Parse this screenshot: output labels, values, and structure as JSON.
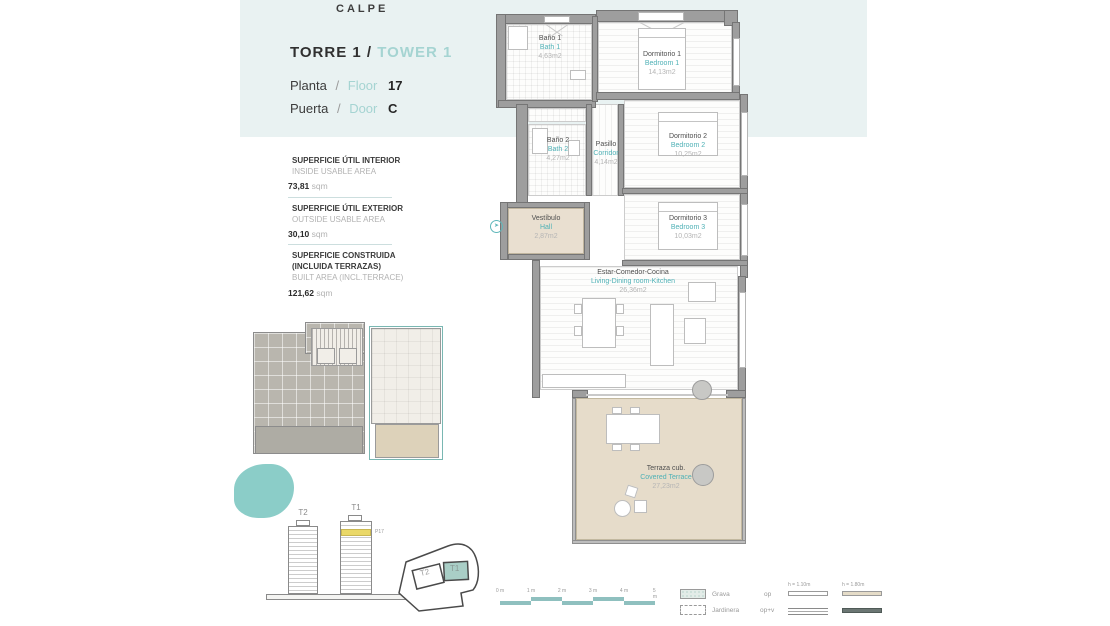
{
  "colors": {
    "header_band": "#e9f2f2",
    "accent_teal": "#4fb1b6",
    "accent_teal_light": "#a5d4d2",
    "wall_gray": "#9e9e9e",
    "floor_beige": "#e6dcca",
    "floor_highlight_yellow": "#ead868",
    "blob_teal": "#8bcdc8"
  },
  "location": "CALPE",
  "header": {
    "tower_es": "TORRE 1",
    "slash": "/",
    "tower_en": "TOWER 1",
    "floor_label_es": "Planta",
    "floor_label_en": "Floor",
    "floor_value": "17",
    "door_label_es": "Puerta",
    "door_label_en": "Door",
    "door_value": "C"
  },
  "area_panel": {
    "sections": [
      {
        "title_es": "SUPERFICIE ÚTIL INTERIOR",
        "title_es2": "",
        "title_en": "INSIDE USABLE AREA",
        "value": "73,81",
        "unit": "sqm"
      },
      {
        "title_es": "SUPERFICIE ÚTIL EXTERIOR",
        "title_es2": "",
        "title_en": "OUTSIDE USABLE AREA",
        "value": "30,10",
        "unit": "sqm"
      },
      {
        "title_es": "SUPERFICIE CONSTRUIDA",
        "title_es2": "(INCLUIDA TERRAZAS)",
        "title_en": "BUILT AREA (INCL.TERRACE)",
        "value": "121,62",
        "unit": "sqm"
      }
    ]
  },
  "plan": {
    "rooms": [
      {
        "name_es": "Baño 1",
        "name_en": "Bath 1",
        "area": "4,63m2"
      },
      {
        "name_es": "Dormitorio 1",
        "name_en": "Bedroom 1",
        "area": "14,13m2"
      },
      {
        "name_es": "Baño 2",
        "name_en": "Bath 2",
        "area": "4,27m2"
      },
      {
        "name_es": "Pasillo",
        "name_en": "Corridor",
        "area": "4,14m2"
      },
      {
        "name_es": "Dormitorio 2",
        "name_en": "Bedroom 2",
        "area": "10,25m2"
      },
      {
        "name_es": "Dormitorio 3",
        "name_en": "Bedroom 3",
        "area": "10,03m2"
      },
      {
        "name_es": "Vestíbulo",
        "name_en": "Hall",
        "area": "2,87m2"
      },
      {
        "name_es": "Estar-Comedor-Cocina",
        "name_en": "Living-Dining room-Kitchen",
        "area": "26,36m2"
      },
      {
        "name_es": "Terraza cub.",
        "name_en": "Covered Terrace",
        "area": "27,23m2"
      }
    ]
  },
  "key_towers": {
    "t2_label": "T2",
    "t1_label": "T1",
    "floor_tag": "P17"
  },
  "site_plan": {
    "t2_label": "T2",
    "t1_label": "T1"
  },
  "scale_bar": {
    "labels": [
      "0 m",
      "1 m",
      "2 m",
      "3 m",
      "4 m",
      "5 m"
    ]
  },
  "legend": {
    "grava_label": "Grava",
    "jardinera_label": "Jardinera",
    "op_label": "op",
    "opv_label": "op+v",
    "h110_label": "h = 1.10m",
    "h180_label": "h = 1.80m"
  }
}
